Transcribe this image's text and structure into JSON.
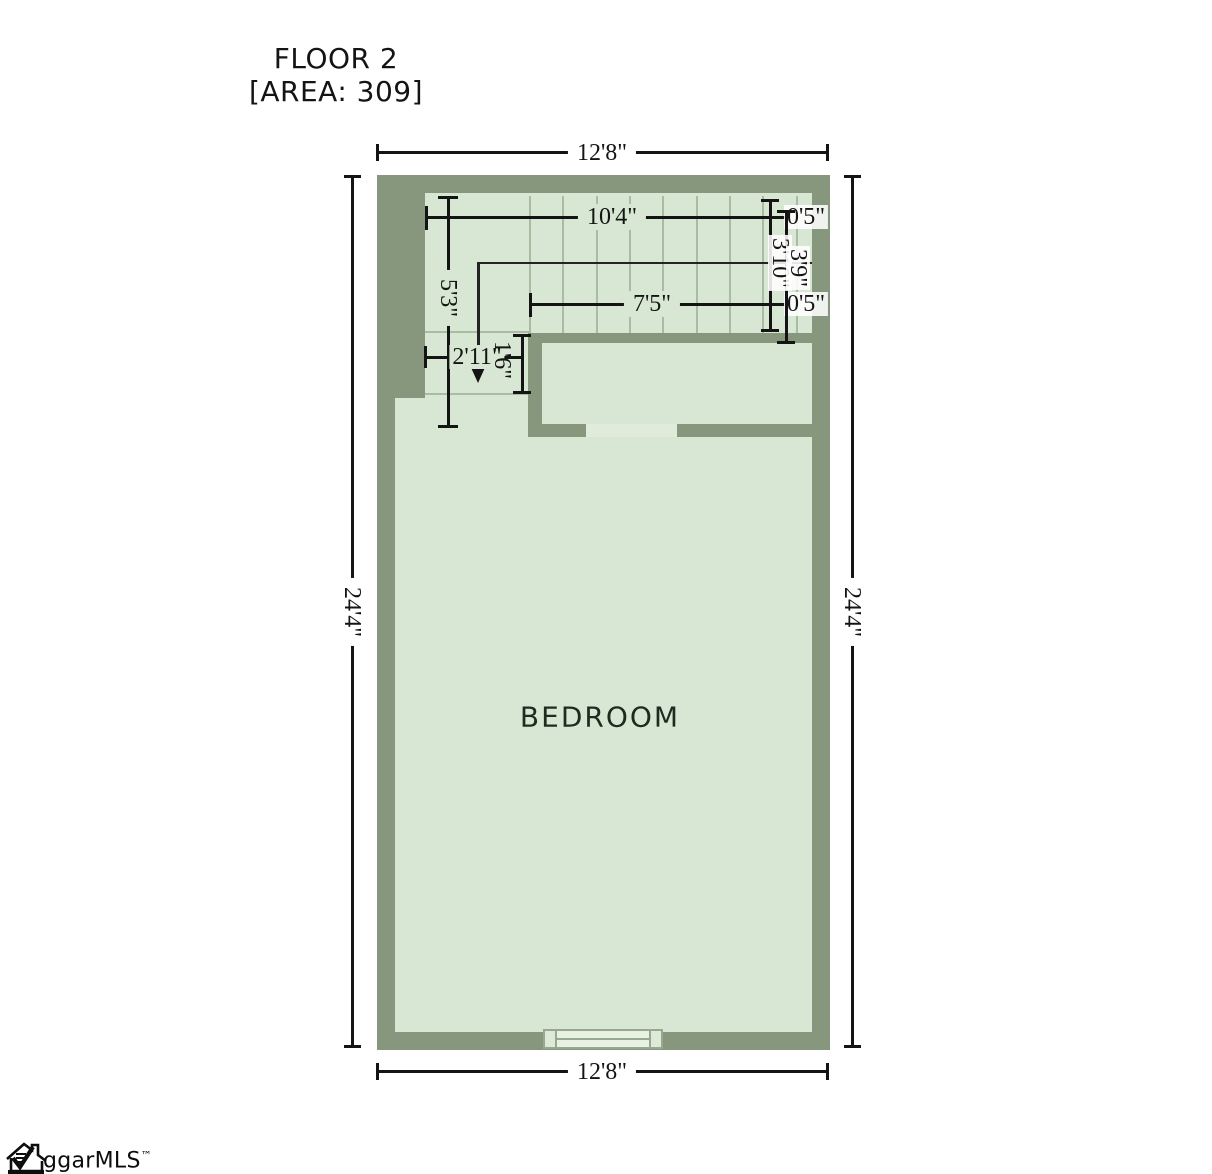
{
  "title": {
    "line1": "FLOOR 2",
    "line2": "[AREA: 309]"
  },
  "floor_plan": {
    "room_label": "BEDROOM",
    "colors": {
      "wall": "#87977e",
      "floor": "#d8e7d3",
      "stair_grid": "#a8bca1",
      "door_gap": "#e0ebdb",
      "window_fill": "#e9f1e5",
      "window_frame": "#96a88f",
      "dimension_ink": "#141414"
    },
    "dimensions": {
      "overall_width_top": "12'8\"",
      "overall_width_bottom": "12'8\"",
      "overall_height_left": "24'4\"",
      "overall_height_right": "24'4\"",
      "stair_width": "10'4\"",
      "stair_offset_top": "0'5\"",
      "stair_run_width": "7'5\"",
      "stair_offset_mid": "0'5\"",
      "landing_height": "5'3\"",
      "landing_width": "2'11\"",
      "landing_depth": "1'6\"",
      "stair_run_a": "3'10\"",
      "stair_run_b": "3'9\""
    }
  },
  "logo": {
    "text": "ggarMLS",
    "trademark": "™"
  }
}
